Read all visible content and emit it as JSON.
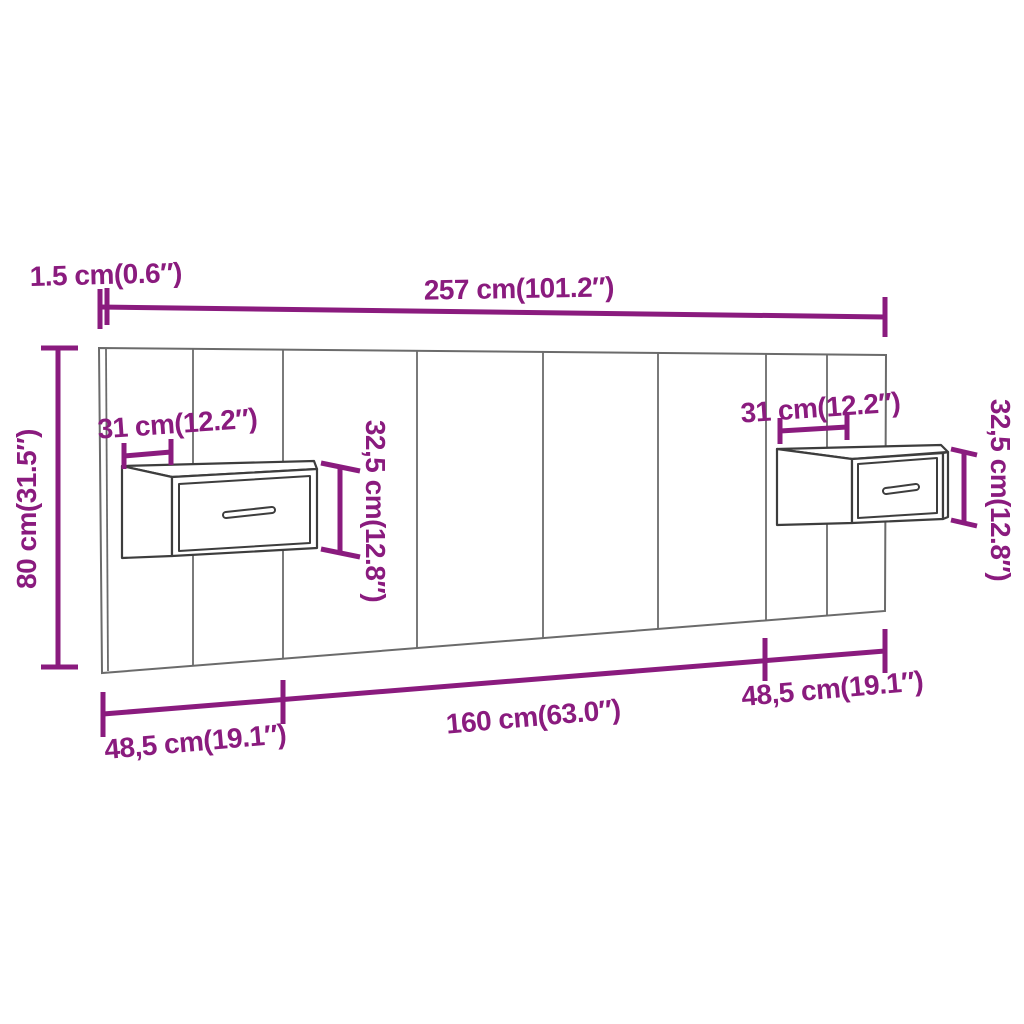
{
  "figure": {
    "type": "furniture-dimension-diagram",
    "subject": "wall headboard with two floating bedside cabinets",
    "colors": {
      "dimension_accent": "#8A1B7E",
      "panel_outline": "#6b6b6b",
      "cabinet_outline": "#3d3d3d",
      "background": "#ffffff"
    },
    "labels": {
      "panel_thickness": "1.5 cm(0.6″)",
      "total_width": "257 cm(101.2″)",
      "total_height": "80 cm(31.5″)",
      "left_cabinet_depth": "31 cm(12.2″)",
      "left_cabinet_height": "32,5 cm(12.8″)",
      "right_cabinet_depth": "31 cm(12.2″)",
      "right_cabinet_height": "32,5 cm(12.8″)",
      "bottom_left_section": "48,5 cm(19.1″)",
      "bottom_center_section": "160 cm(63.0″)",
      "bottom_right_section": "48,5 cm(19.1″)"
    }
  }
}
